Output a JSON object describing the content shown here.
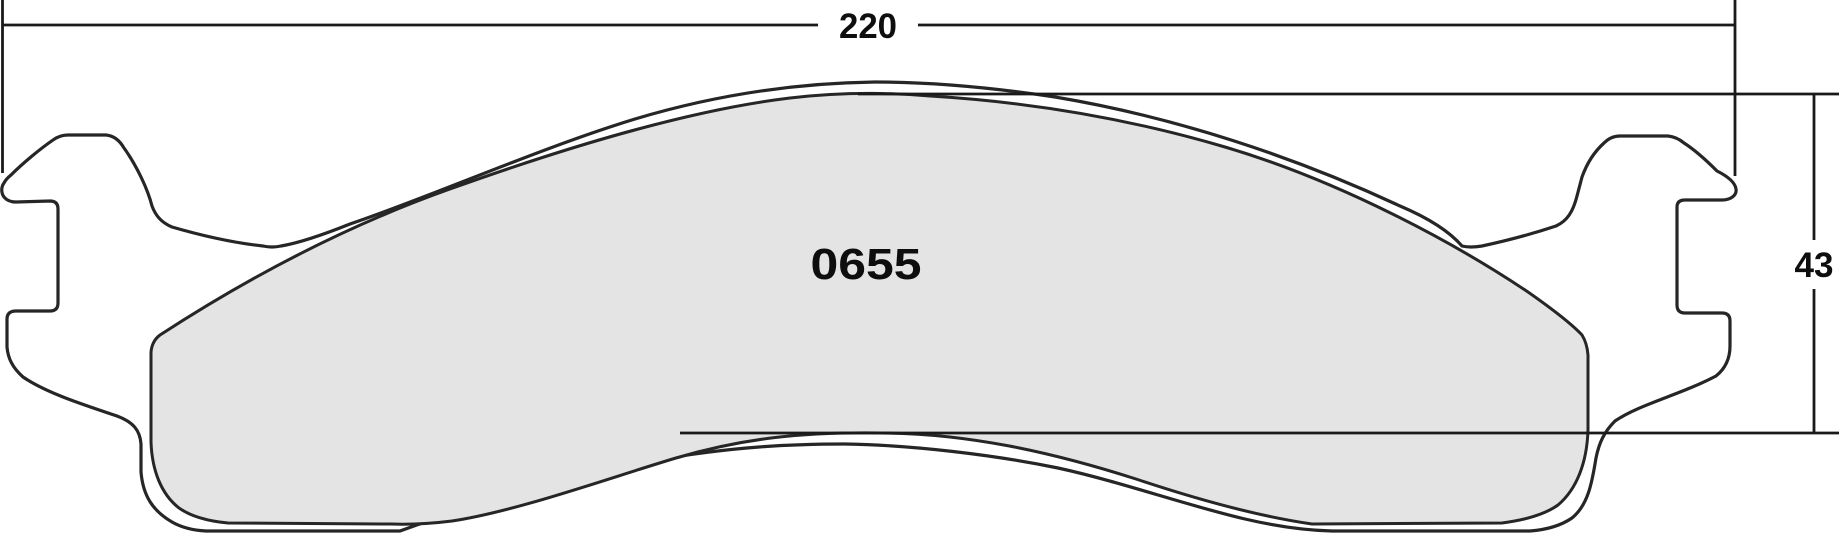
{
  "drawing": {
    "part_number": "0655",
    "width_dimension": "220",
    "height_dimension": "43"
  },
  "colors": {
    "outline": "#262626",
    "dimension_line": "#1a1a1a",
    "text": "#0e0e0e",
    "plate_fill": "#ffffff",
    "friction_fill": "#e4e4e4",
    "background": "#ffffff"
  }
}
